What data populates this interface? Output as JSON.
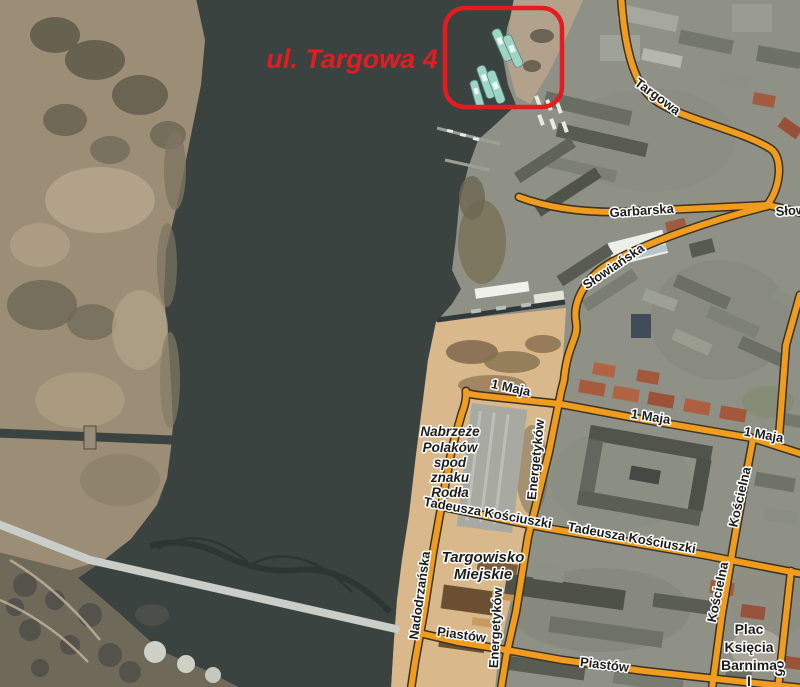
{
  "annotation": {
    "label": "ul. Targowa 4"
  },
  "labels": {
    "streets": [
      {
        "t": "Targowa"
      },
      {
        "t": "Garbarska"
      },
      {
        "t": "Słowiańska"
      },
      {
        "t": "Słowiańska"
      },
      {
        "t": "1 Maja"
      },
      {
        "t": "1 Maja"
      },
      {
        "t": "1 Maja"
      },
      {
        "t": "Energetyków"
      },
      {
        "t": "Energetyków"
      },
      {
        "t": "Kościelna"
      },
      {
        "t": "Kościelna"
      },
      {
        "t": "Tadeusza Kościuszki"
      },
      {
        "t": "Tadeusza Kościuszki"
      },
      {
        "t": "Nadodrzańska"
      },
      {
        "t": "Piastów"
      },
      {
        "t": "Piastów"
      },
      {
        "t": "go"
      }
    ],
    "places": {
      "quay": [
        "Nabrzeże",
        "Polaków",
        "spod",
        "znaku",
        "Rodła"
      ],
      "market": [
        "Targowisko",
        "Miejskie"
      ],
      "square": [
        "Plac",
        "Księcia",
        "Barnima",
        "I"
      ]
    }
  },
  "colors": {
    "water": "#3b4340",
    "marsh": "#9c8d76",
    "city": "#8f9186",
    "sand": "#d9b98b",
    "street": "#f09c1e",
    "street_casing": "#3a3224",
    "label_text": "#1d1d1b",
    "label_halo": "#ffffff",
    "annotation_red": "#e41b1f",
    "boat_teal": "#9ed6c6",
    "bridge_deck": "#c9cfc8",
    "bridge_dark": "#2d3633"
  }
}
